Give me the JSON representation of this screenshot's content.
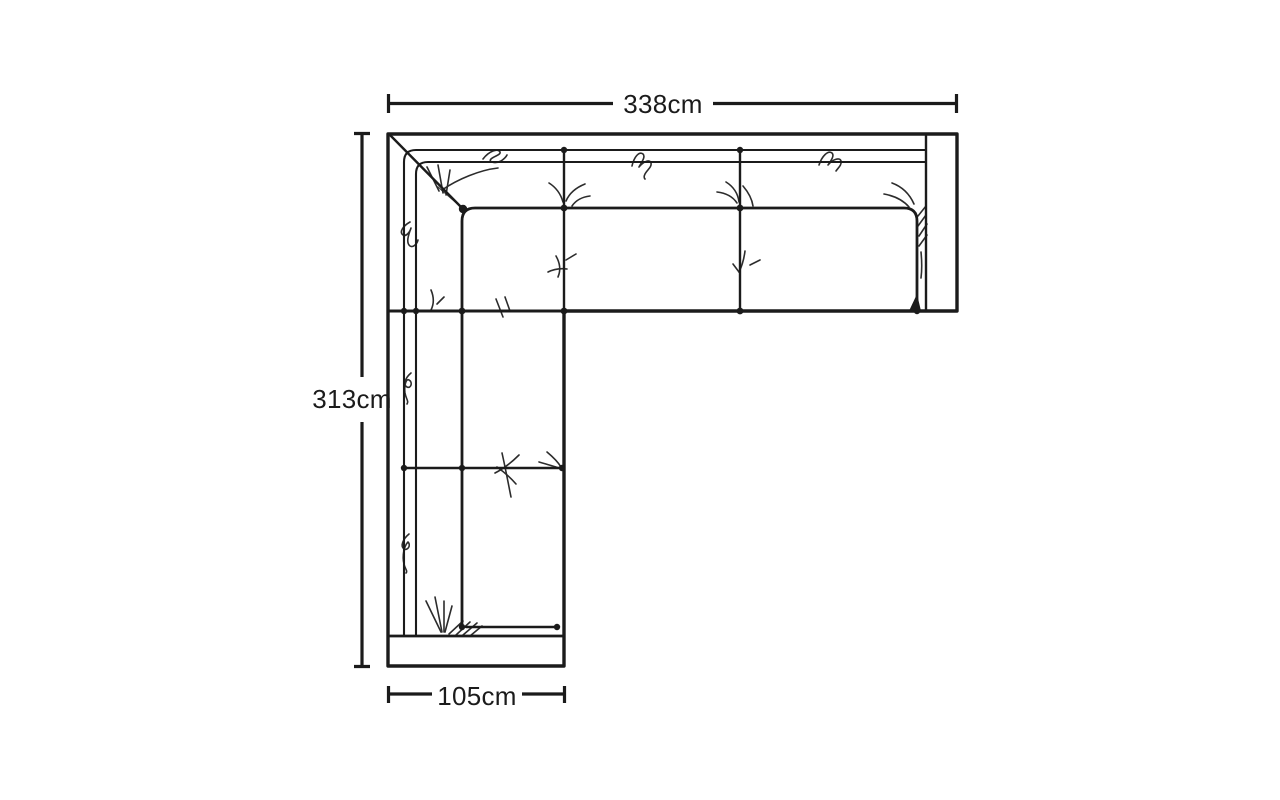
{
  "page": {
    "background": "#ffffff",
    "ink": "#1b1b1b"
  },
  "diagram": {
    "type": "furniture-dimension-sketch",
    "subject": "corner-sofa-top-view",
    "dimensions": {
      "width": {
        "label": "338cm",
        "side": "top"
      },
      "height": {
        "label": "313cm",
        "side": "left"
      },
      "depth": {
        "label": "105cm",
        "side": "bottom"
      }
    }
  }
}
